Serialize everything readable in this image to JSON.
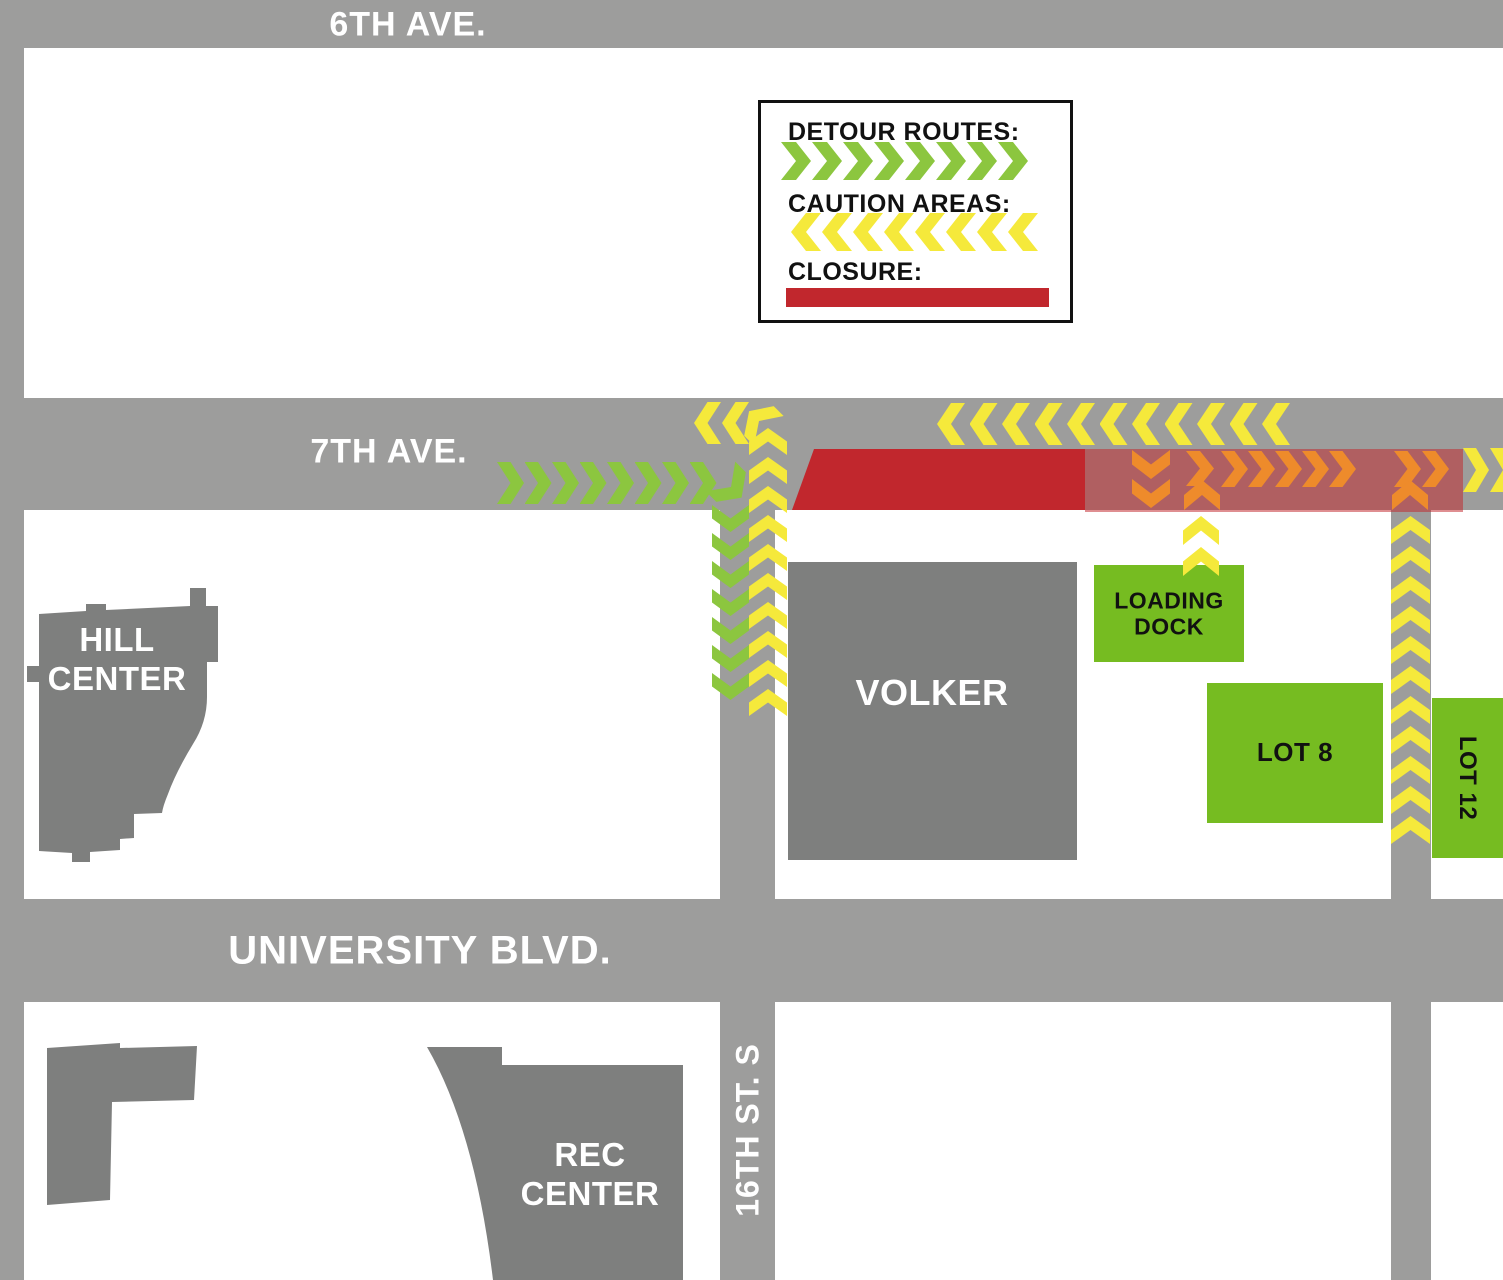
{
  "title": "Campus street closure and detour map",
  "colors": {
    "road_gray": "#9D9D9C",
    "building_gray": "#7E7F7E",
    "detour_green": "#8CC63F",
    "caution_yellow": "#F5E93B",
    "closure_red": "#C1272D",
    "caution_zone_pink": "rgba(193,39,45,0.52)",
    "alt_route_orange": "#EE8B2B",
    "lot_green": "#76BC21"
  },
  "legend": {
    "detour_label": "DETOUR ROUTES:",
    "caution_label": "CAUTION AREAS:",
    "closure_label": "CLOSURE:"
  },
  "streets": {
    "sixth_ave": "6TH AVE.",
    "seventh_ave": "7TH AVE.",
    "university_blvd": "UNIVERSITY BLVD.",
    "sixteenth_st": "16TH ST. S"
  },
  "buildings": {
    "hill_center_line1": "HILL",
    "hill_center_line2": "CENTER",
    "volker": "VOLKER",
    "rec_center_line1": "REC",
    "rec_center_line2": "CENTER"
  },
  "areas": {
    "loading_dock_line1": "LOADING",
    "loading_dock_line2": "DOCK",
    "lot8": "LOT 8",
    "lot12": "LOT 12"
  },
  "map": {
    "arrow_groups": [
      {
        "name": "legend-detour-arrows",
        "color": "detour_green",
        "dir": "right",
        "x": 781,
        "y": 142,
        "w": 30,
        "h": 38,
        "count": 8,
        "dx": 31,
        "dy": 0
      },
      {
        "name": "legend-caution-arrows",
        "color": "caution_yellow",
        "dir": "left",
        "x": 791,
        "y": 213,
        "w": 30,
        "h": 38,
        "count": 8,
        "dx": 31,
        "dy": 0
      },
      {
        "name": "detour-7th-ave-eastbound",
        "color": "detour_green",
        "dir": "right",
        "x": 497,
        "y": 462,
        "w": 27,
        "h": 42,
        "count": 8,
        "dx": 27.5,
        "dy": 0
      },
      {
        "name": "detour-turn-south",
        "color": "detour_green",
        "dir": "right",
        "x": 716,
        "y": 466,
        "w": 30,
        "h": 42,
        "count": 1,
        "dx": 0,
        "dy": 0,
        "rot": 45
      },
      {
        "name": "detour-16th-st-southbound",
        "color": "detour_green",
        "dir": "down",
        "x": 712,
        "y": 505,
        "w": 37,
        "h": 27,
        "count": 7,
        "dx": 0,
        "dy": 28
      },
      {
        "name": "caution-16th-st-northbound",
        "color": "caution_yellow",
        "dir": "up",
        "x": 749,
        "y": 428,
        "w": 38,
        "h": 27,
        "count": 10,
        "dx": 0,
        "dy": 29
      },
      {
        "name": "caution-turn-west",
        "color": "caution_yellow",
        "dir": "left",
        "x": 745,
        "y": 400,
        "w": 28,
        "h": 42,
        "count": 1,
        "dx": 0,
        "dy": 0,
        "rot": 45
      },
      {
        "name": "caution-7th-ave-west-near",
        "color": "caution_yellow",
        "dir": "left",
        "x": 694,
        "y": 402,
        "w": 27,
        "h": 42,
        "count": 2,
        "dx": 28,
        "dy": 0
      },
      {
        "name": "caution-7th-ave-westbound",
        "color": "caution_yellow",
        "dir": "left",
        "x": 937,
        "y": 403,
        "w": 28,
        "h": 42,
        "count": 11,
        "dx": 32.5,
        "dy": 0
      },
      {
        "name": "alt-route-down-into-zone",
        "color": "alt_route_orange",
        "dir": "down",
        "x": 1132,
        "y": 450,
        "w": 38,
        "h": 29,
        "count": 2,
        "dx": 0,
        "dy": 29
      },
      {
        "name": "alt-route-zig-right",
        "color": "alt_route_orange",
        "dir": "right",
        "x": 1186,
        "y": 451,
        "w": 28,
        "h": 35,
        "count": 1,
        "dx": 0,
        "dy": 0
      },
      {
        "name": "alt-route-zig-up",
        "color": "alt_route_orange",
        "dir": "up",
        "x": 1184,
        "y": 480,
        "w": 36,
        "h": 30,
        "count": 1,
        "dx": 0,
        "dy": 0
      },
      {
        "name": "alt-route-eastbound",
        "color": "alt_route_orange",
        "dir": "right",
        "x": 1221,
        "y": 451,
        "w": 27,
        "h": 36,
        "count": 5,
        "dx": 27,
        "dy": 0
      },
      {
        "name": "alt-route-eastbound-far",
        "color": "alt_route_orange",
        "dir": "right",
        "x": 1394,
        "y": 451,
        "w": 27,
        "h": 36,
        "count": 2,
        "dx": 28,
        "dy": 0
      },
      {
        "name": "alt-route-up-from-road",
        "color": "alt_route_orange",
        "dir": "up",
        "x": 1392,
        "y": 480,
        "w": 36,
        "h": 30,
        "count": 1,
        "dx": 0,
        "dy": 0
      },
      {
        "name": "caution-east-exit",
        "color": "caution_yellow",
        "dir": "right",
        "x": 1463,
        "y": 448,
        "w": 26,
        "h": 44,
        "count": 2,
        "dx": 27,
        "dy": 0
      },
      {
        "name": "caution-loading-dock-entry",
        "color": "caution_yellow",
        "dir": "up",
        "x": 1183,
        "y": 516,
        "w": 36,
        "h": 29,
        "count": 2,
        "dx": 0,
        "dy": 31
      },
      {
        "name": "caution-east-road-northbound",
        "color": "caution_yellow",
        "dir": "up",
        "x": 1391,
        "y": 516,
        "w": 39,
        "h": 28,
        "count": 11,
        "dx": 0,
        "dy": 30
      }
    ]
  }
}
